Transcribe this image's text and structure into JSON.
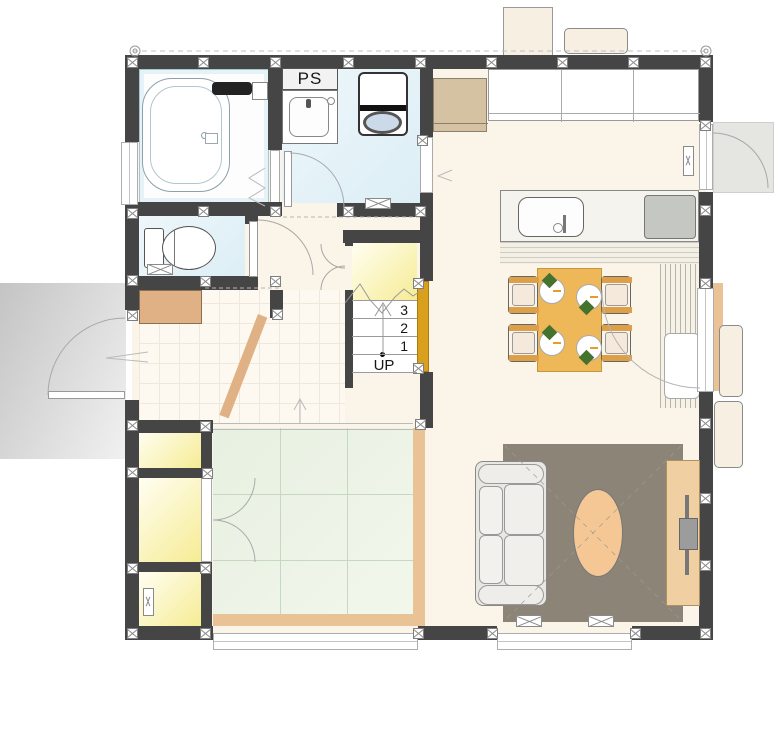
{
  "labels": {
    "pipe_space": "PS"
  },
  "stairs": {
    "direction_label": "UP",
    "step_numbers": [
      "3",
      "2",
      "1"
    ]
  },
  "fixtures": [
    "bathtub",
    "bathroom-counter",
    "washbasin",
    "washing-machine",
    "toilet",
    "shoe-cabinet",
    "refrigerator",
    "wall-cabinet",
    "kitchen-counter",
    "kitchen-sink",
    "cooktop",
    "dining-table",
    "dining-chair",
    "plate",
    "napkin",
    "sofa",
    "coffee-table",
    "tv-board",
    "rug",
    "tatami-mat",
    "wood-deck-slats",
    "water-heater-unit",
    "ac-outdoor-unit",
    "front-door",
    "back-door",
    "glass-door"
  ],
  "colors": {
    "wall": "#454545",
    "floor": "#fbf4e8",
    "wet_floor": "#dceef6",
    "wet_floor_light": "#eef7fa",
    "tatami": "#e7f0e1",
    "tatami_light": "#f2f7ec",
    "tatami_line": "#c6d8c0",
    "closet_yellow": "#f6ec94",
    "closet_light": "#fffef2",
    "wood": "#e9c395",
    "wood_dark": "#dfb184",
    "table_orange": "#eeb859",
    "rug": "#8b8477",
    "gold": "#d8a01d",
    "porch": "#c4c4c4",
    "coffee_table": "#f4c795",
    "tv_board": "#f0cfa2",
    "fridge": "#d5c2a3",
    "counter": "#f4f3ee",
    "cooktop": "#c5c7c3",
    "napkin": "#46722f",
    "chair_seat": "#f4e9da",
    "chair_arm": "#dd9f47",
    "sofa": "#e9e7e2",
    "appliance": "#f6efe2",
    "backporch": "#e5e5e2",
    "slat_bg": "#f6f2e8",
    "slat_line": "#b7b3a7"
  }
}
